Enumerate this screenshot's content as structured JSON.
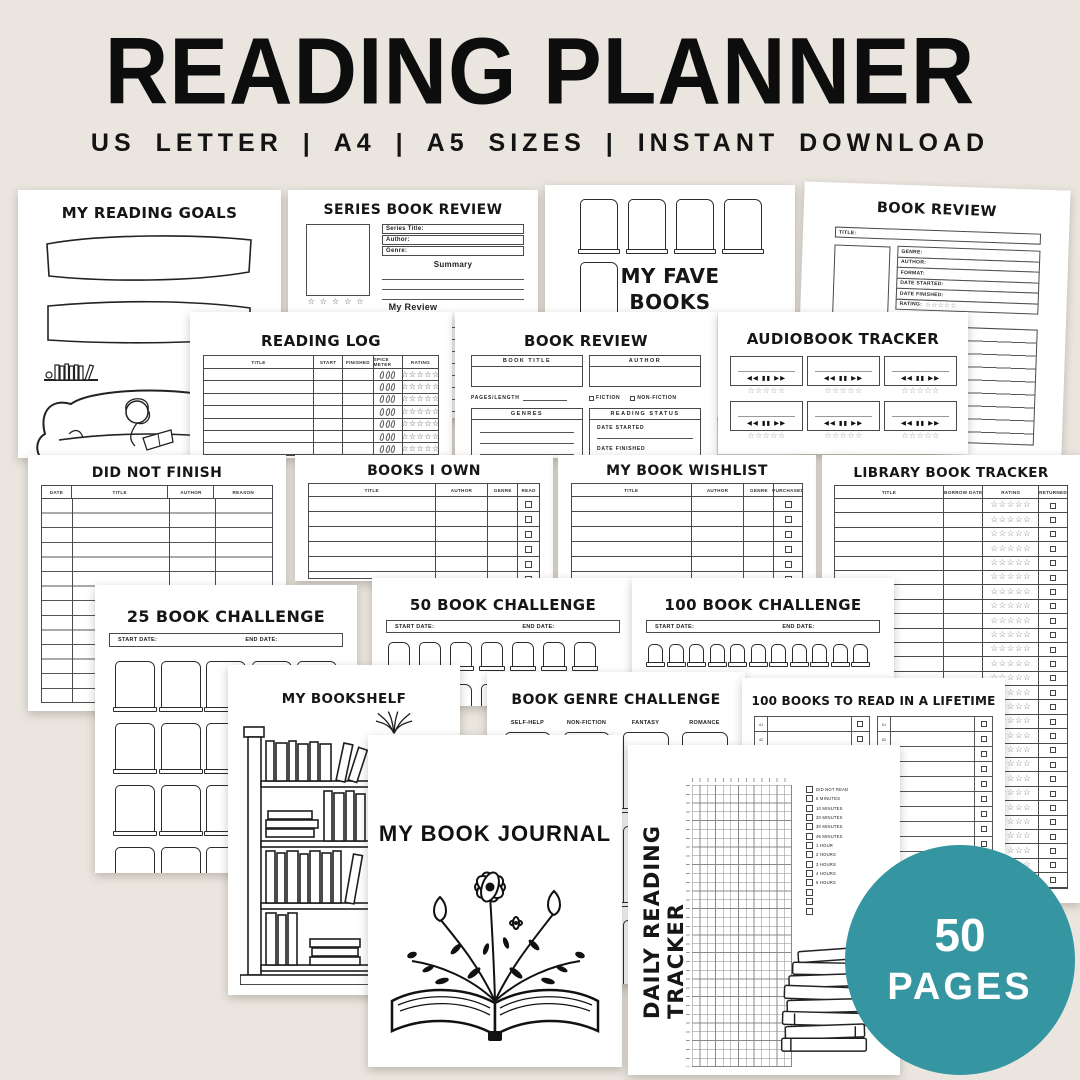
{
  "colors": {
    "background": "#EAE6DF",
    "page": "#FFFFFF",
    "ink": "#1C1C1C",
    "badge_teal": "#3596A1",
    "star_grey": "#8F8F8F"
  },
  "header": {
    "title": "READING PLANNER",
    "subtitle": "US LETTER | A4 | A5 SIZES | INSTANT DOWNLOAD"
  },
  "badge": {
    "value": "50",
    "label": "PAGES"
  },
  "icons": {
    "star": "☆",
    "stars5": "☆☆☆☆☆",
    "rewind": "◀◀",
    "pause": "▮▮",
    "forward": "▶▶"
  },
  "pages": {
    "reading_goals": {
      "title": "MY READING GOALS"
    },
    "series_review": {
      "title": "SERIES BOOK REVIEW",
      "series_title_label": "Series Title:",
      "author_label": "Author:",
      "genre_label": "Genre:",
      "summary_label": "Summary",
      "review_label": "My Review"
    },
    "fave_books": {
      "title_line1": "MY FAVE",
      "title_line2": "BOOKS"
    },
    "book_review_right": {
      "title": "BOOK REVIEW",
      "title_label": "TITLE:",
      "genre_label": "GENRE:",
      "author_label": "AUTHOR:",
      "format_label": "FORMAT:",
      "date_started_label": "DATE STARTED:",
      "date_finished_label": "DATE FINISHED:",
      "rating_label": "RATING:"
    },
    "reading_log": {
      "title": "READING LOG",
      "columns": [
        "TITLE",
        "START",
        "FINISHED",
        "SPICE METER",
        "RATING"
      ]
    },
    "book_review_mid": {
      "title": "BOOK REVIEW",
      "book_title_label": "BOOK TITLE",
      "author_label": "AUTHOR",
      "pages_length_label": "PAGES/LENGTH",
      "fiction_label": "FICTION",
      "nonfiction_label": "NON-FICTION",
      "genres_label": "GENRES",
      "reading_status_label": "READING STATUS",
      "date_started_label": "DATE STARTED",
      "date_finished_label": "DATE FINISHED"
    },
    "audiobook_tracker": {
      "title": "AUDIOBOOK TRACKER"
    },
    "did_not_finish": {
      "title": "DID NOT FINISH",
      "columns": [
        "DATE",
        "TITLE",
        "AUTHOR",
        "REASON"
      ]
    },
    "books_i_own": {
      "title": "BOOKS I OWN",
      "columns": [
        "TITLE",
        "AUTHOR",
        "GENRE",
        "READ"
      ]
    },
    "book_wishlist": {
      "title": "MY BOOK WISHLIST",
      "columns": [
        "TITLE",
        "AUTHOR",
        "GENRE",
        "PURCHASED"
      ]
    },
    "library_tracker": {
      "title": "LIBRARY BOOK TRACKER",
      "columns": [
        "TITLE",
        "BORROW DATE",
        "RATING",
        "RETURNED"
      ]
    },
    "challenge_25": {
      "title": "25 BOOK CHALLENGE",
      "start_label": "START DATE:",
      "end_label": "END DATE:"
    },
    "challenge_50": {
      "title": "50 BOOK CHALLENGE",
      "start_label": "START DATE:",
      "end_label": "END DATE:"
    },
    "challenge_100": {
      "title": "100 BOOK CHALLENGE",
      "start_label": "START DATE:",
      "end_label": "END DATE:"
    },
    "bookshelf": {
      "title": "MY BOOKSHELF"
    },
    "genre_challenge": {
      "title": "BOOK GENRE CHALLENGE",
      "genres": [
        "SELF-HELP",
        "NON-FICTION",
        "FANTASY",
        "ROMANCE"
      ]
    },
    "lifetime_list": {
      "title": "100 BOOKS TO READ IN A LIFETIME",
      "left_numbers": [
        "41",
        "42",
        "43",
        "44",
        "45",
        "46",
        "47",
        "48",
        "49",
        "50",
        "51",
        "52",
        "53",
        "54",
        "55",
        "56",
        "57",
        "58",
        "59",
        "60"
      ],
      "right_numbers": [
        "61",
        "62",
        "63",
        "64",
        "65",
        "66",
        "67",
        "68",
        "69",
        "70",
        "71",
        "72",
        "73",
        "74",
        "75",
        "76",
        "77",
        "78",
        "79",
        "80"
      ]
    },
    "daily_tracker": {
      "title": "DAILY READING TRACKER",
      "legend": [
        "DID NOT READ",
        "5 MINUTES",
        "10 MINUTES",
        "20 MINUTES",
        "30 MINUTES",
        "45 MINUTES",
        "1 HOUR",
        "2 HOURS",
        "3 HOURS",
        "4 HOURS",
        "5 HOURS"
      ]
    },
    "book_journal": {
      "title": "MY BOOK JOURNAL"
    }
  }
}
